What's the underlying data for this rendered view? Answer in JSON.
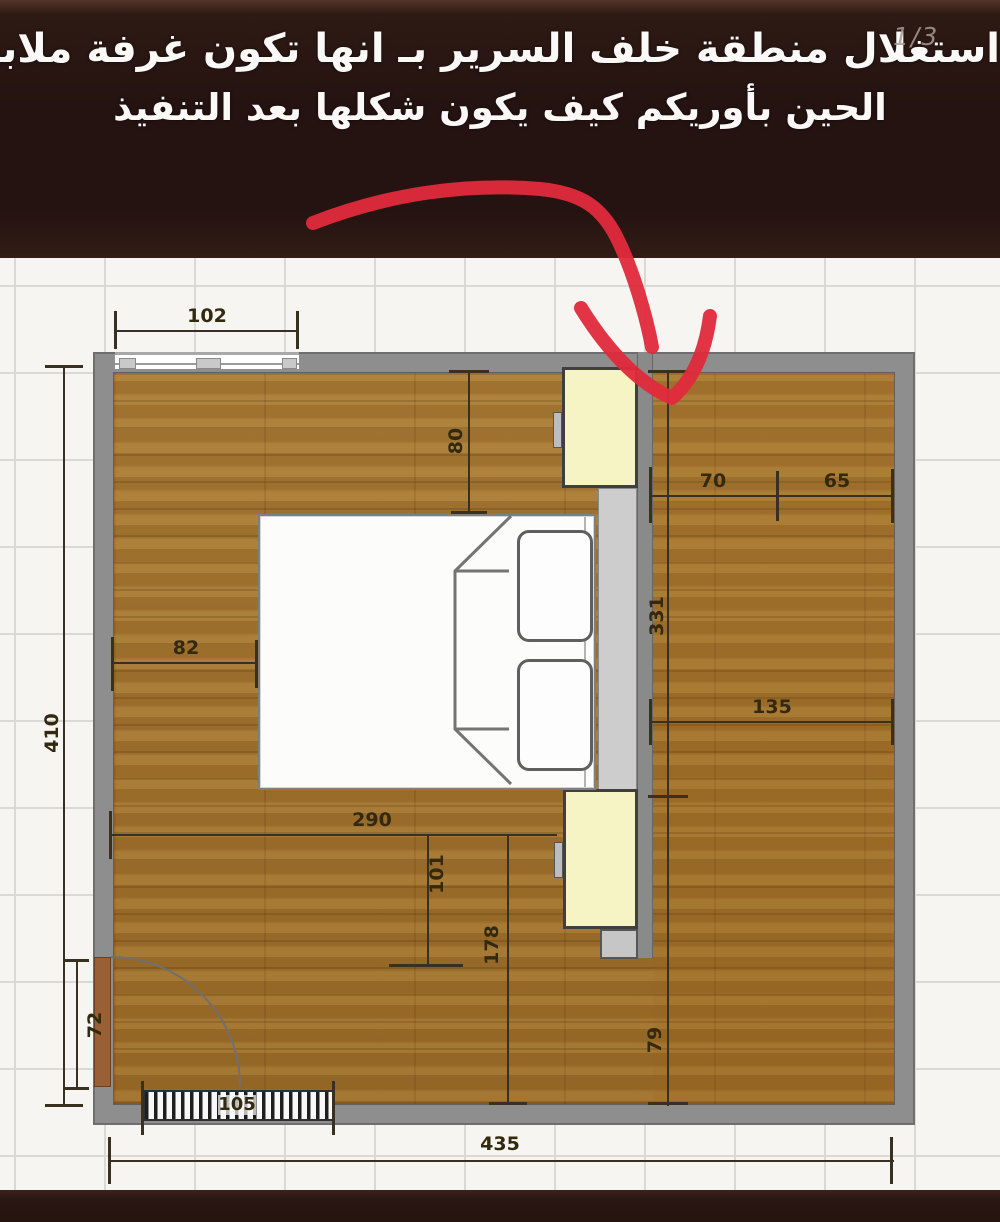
{
  "header": {
    "line1": "استغلال منطقة خلف السرير بـ انها تكون غرفة ملابس",
    "line2": "الحين بأوريكم كيف يكون شكلها بعد التنفيذ",
    "page_indicator": "1/3",
    "ok_hand_icon": "ok-hand-emoji"
  },
  "colors": {
    "header_bg": "#251311",
    "arrow_red": "#e02a3c",
    "wood_floor": "#a4762f",
    "wall_gray": "#8e8e8e",
    "wardrobe_cream": "#f6f3c5",
    "tile_bg": "#f6f5f2",
    "dimension_text": "#33290f"
  },
  "plan": {
    "dims": {
      "window_width": "102",
      "left_wall_height": "410",
      "top_gap": "80",
      "closet_seg_a": "70",
      "closet_seg_b": "65",
      "closet_length": "331",
      "closet_width": "135",
      "bed_side_gap": "82",
      "bed_run": "290",
      "inner_a": "101",
      "inner_b": "178",
      "door_width": "72",
      "closet_opening": "79",
      "radiator_width": "105",
      "bottom_wall_width": "435"
    }
  }
}
